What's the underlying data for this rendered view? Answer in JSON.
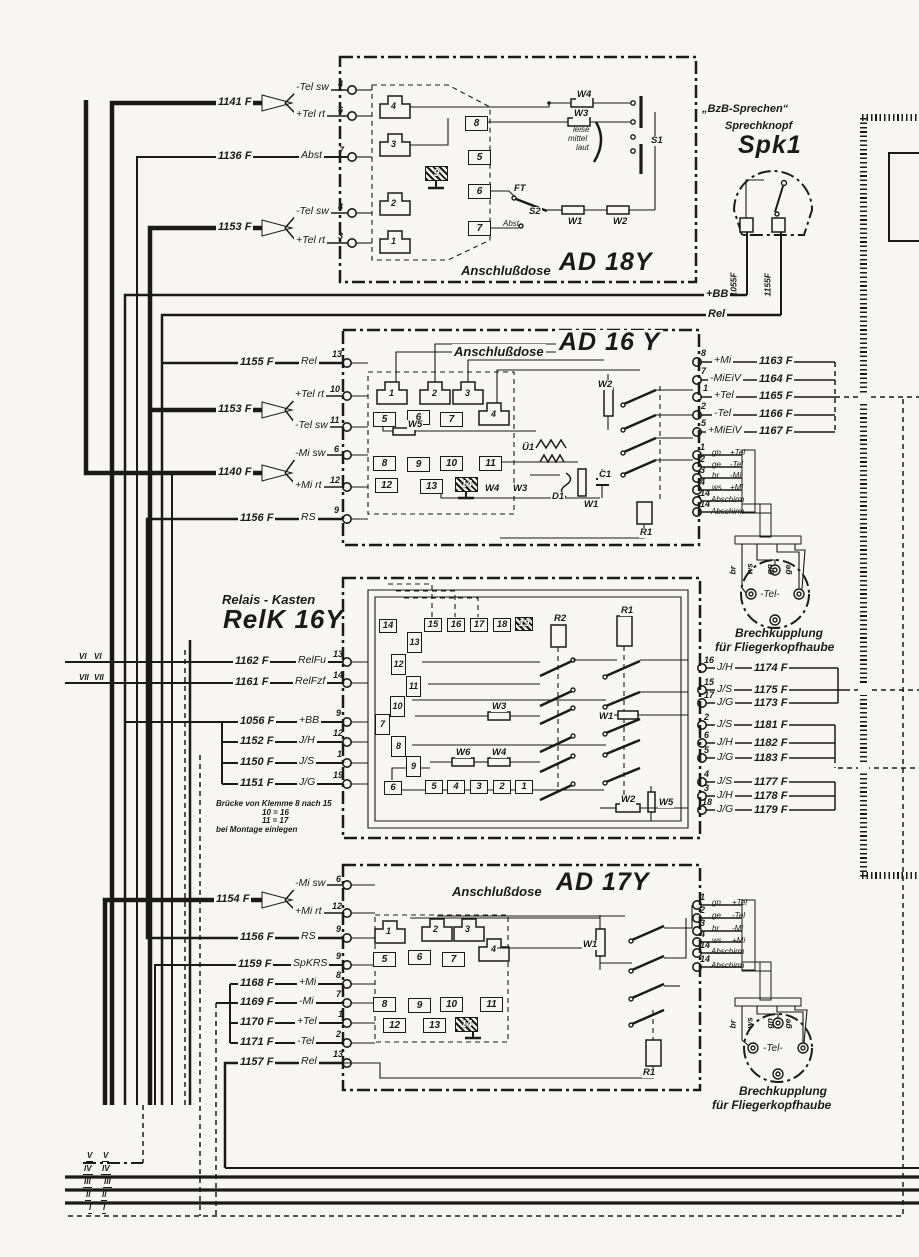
{
  "palette": {
    "ink": "#1a1a1a",
    "paper": "#f7f6f2"
  },
  "spk1": {
    "quote": "„BzB-Sprechen“",
    "subtitle": "Sprechknopf",
    "name": "Spk1",
    "cable_left": "1055F",
    "cable_right": "1155F"
  },
  "bus": {
    "bb": "+BB",
    "rel": "Rel"
  },
  "ad18y": {
    "title_prefix": "Anschlußdose",
    "title": "AD 18Y",
    "rows": [
      {
        "cable": "1141 F",
        "sig_a": "-Tel sw",
        "pin_a": "4",
        "sig_b": "+Tel rt",
        "pin_b": "6"
      },
      {
        "cable": "1136 F",
        "sig": "Abst",
        "pin": "7"
      },
      {
        "cable": "1153 F",
        "sig_a": "-Tel sw",
        "pin_a": "4",
        "sig_b": "+Tel rt",
        "pin_b": "3"
      }
    ],
    "plugs": [
      "4",
      "3",
      "2",
      "1"
    ],
    "terms": [
      "8",
      "5",
      "9",
      "6",
      "7"
    ],
    "comps": {
      "w4": "W4",
      "w3": "W3",
      "w1": "W1",
      "w2": "W2",
      "s1": "S1",
      "s2": "S2",
      "ft": "FT",
      "abst": "Abst",
      "vol1": "leise",
      "vol2": "mittel",
      "vol3": "laut"
    }
  },
  "ad16y": {
    "title_prefix": "Anschlußdose",
    "title": "AD 16 Y",
    "rows": [
      {
        "cable": "1155 F",
        "sig": "Rel",
        "pin": "13"
      },
      {
        "cable": "1153 F",
        "sig_a": "+Tel rt",
        "pin_a": "10",
        "sig_b": "-Tel sw",
        "pin_b": "11"
      },
      {
        "cable": "1140 F",
        "sig_a": "-Mi sw",
        "pin_a": "6",
        "sig_b": "+Mi rt",
        "pin_b": "12"
      },
      {
        "cable": "1156 F",
        "sig": "RS",
        "pin": "9"
      }
    ],
    "plugs": [
      "1",
      "2",
      "3",
      "4"
    ],
    "terms": [
      "5",
      "6",
      "7",
      "8",
      "9",
      "10",
      "11",
      "12",
      "13",
      "14"
    ],
    "comps": {
      "w5": "W5",
      "w4": "W4",
      "w3": "W3",
      "u1": "Ü1",
      "d1": "D1",
      "w1": "W1",
      "c1": "C1",
      "w2": "W2",
      "r1": "R1"
    },
    "right": [
      {
        "pin": "8",
        "sig": "+Mi",
        "cable": "1163 F"
      },
      {
        "pin": "7",
        "sig": "-MiEiV",
        "cable": "1164 F"
      },
      {
        "pin": "1",
        "sig": "+Tel",
        "cable": "1165 F"
      },
      {
        "pin": "2",
        "sig": "-Tel",
        "cable": "1166 F"
      },
      {
        "pin": "5",
        "sig": "+MiEiV",
        "cable": "1167 F"
      }
    ],
    "headset": [
      {
        "pin": "1",
        "color": "gn",
        "sig": "+Tel"
      },
      {
        "pin": "2",
        "color": "ge",
        "sig": "-Tel"
      },
      {
        "pin": "3",
        "color": "br",
        "sig": "-Mi"
      },
      {
        "pin": "4",
        "color": "ws",
        "sig": "+Mi"
      },
      {
        "pin": "14",
        "sig": "Abschirm"
      },
      {
        "pin": "14",
        "sig": "Abschirm"
      }
    ]
  },
  "relk": {
    "title_prefix": "Relais - Kasten",
    "title": "RelK 16Y",
    "rows": [
      {
        "cable": "1162 F",
        "sig": "RelFu",
        "pin": "13"
      },
      {
        "cable": "1161 F",
        "sig": "RelFzf",
        "pin": "14"
      },
      {
        "cable": "1056 F",
        "sig": "+BB",
        "pin": "9"
      },
      {
        "cable": "1152 F",
        "sig": "J/H",
        "pin": "12"
      },
      {
        "cable": "1150 F",
        "sig": "J/S",
        "pin": "1"
      },
      {
        "cable": "1151 F",
        "sig": "J/G",
        "pin": "19"
      }
    ],
    "note": [
      "Brücke von Klemme 8 nach 15",
      "10  =  16",
      "11  =  17",
      "bei Montage einlegen"
    ],
    "marks": [
      "VI",
      "VII"
    ],
    "terms_top": [
      "14",
      "15",
      "16",
      "17",
      "18",
      "19"
    ],
    "terms_left": [
      "13",
      "12",
      "11",
      "10",
      "7",
      "8",
      "9"
    ],
    "terms_bottom": [
      "6",
      "5",
      "4",
      "3",
      "2",
      "1"
    ],
    "comps": {
      "r2": "R2",
      "r1": "R1",
      "w3": "W3",
      "w6": "W6",
      "w4": "W4",
      "w1": "W1",
      "w2": "W2",
      "w5": "W5"
    },
    "right": [
      {
        "pin": "16",
        "sig": "J/H",
        "cable": "1174 F"
      },
      {
        "pin": "15",
        "sig": "J/S",
        "cable": "1175 F"
      },
      {
        "pin": "17",
        "sig": "J/G",
        "cable": "1173 F"
      },
      {
        "pin": "2",
        "sig": "J/S",
        "cable": "1181 F"
      },
      {
        "pin": "6",
        "sig": "J/H",
        "cable": "1182 F"
      },
      {
        "pin": "5",
        "sig": "J/G",
        "cable": "1183 F"
      },
      {
        "pin": "4",
        "sig": "J/S",
        "cable": "1177 F"
      },
      {
        "pin": "3",
        "sig": "J/H",
        "cable": "1178 F"
      },
      {
        "pin": "18",
        "sig": "J/G",
        "cable": "1179 F"
      }
    ]
  },
  "ad17y": {
    "title_prefix": "Anschlußdose",
    "title": "AD 17Y",
    "rows": [
      {
        "cable": "1154 F",
        "sig_a": "-Mi sw",
        "pin_a": "6",
        "sig_b": "+Mi rt",
        "pin_b": "12"
      },
      {
        "cable": "1156 F",
        "sig": "RS",
        "pin": "9"
      },
      {
        "cable": "1159 F",
        "sig": "SpKRS",
        "pin": "9"
      },
      {
        "cable": "1168 F",
        "sig": "+Mi",
        "pin": "8"
      },
      {
        "cable": "1169 F",
        "sig": "-Mi",
        "pin": "7"
      },
      {
        "cable": "1170 F",
        "sig": "+Tel",
        "pin": "1"
      },
      {
        "cable": "1171 F",
        "sig": "-Tel",
        "pin": "2"
      },
      {
        "cable": "1157 F",
        "sig": "Rel",
        "pin": "13"
      }
    ],
    "plugs": [
      "1",
      "2",
      "3",
      "4"
    ],
    "terms": [
      "5",
      "6",
      "7",
      "8",
      "9",
      "10",
      "11",
      "12",
      "13",
      "14"
    ],
    "comps": {
      "w1": "W1",
      "r1": "R1"
    },
    "headset": [
      {
        "pin": "1",
        "color": "gn",
        "sig": "+Tel"
      },
      {
        "pin": "2",
        "color": "ge",
        "sig": "-Tel"
      },
      {
        "pin": "3",
        "color": "br",
        "sig": "-Mi"
      },
      {
        "pin": "4",
        "color": "ws",
        "sig": "+Mi"
      },
      {
        "pin": "14",
        "sig": "Abschirm"
      },
      {
        "pin": "14",
        "sig": "Abschirm"
      }
    ]
  },
  "kupplung": {
    "wires": [
      "br",
      "ws",
      "gn",
      "ge"
    ],
    "center": "-Tel-",
    "caption1": "Brechkupplung",
    "caption2": "für Fliegerkopfhaube"
  },
  "bus_marks": [
    "V",
    "IV",
    "III",
    "II",
    "I"
  ]
}
